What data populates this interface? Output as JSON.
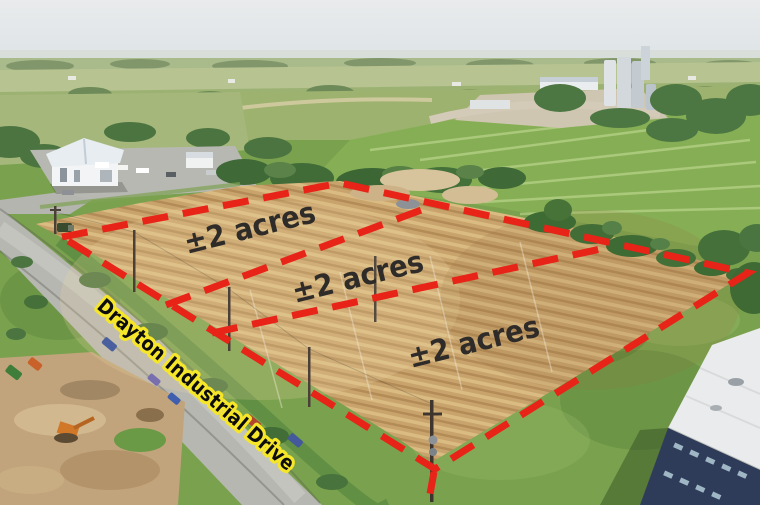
{
  "image": {
    "type": "aerial-drone-photo",
    "subject": "Graded dirt lot outlined with red dashed property boundary, divided into three parcels, beside Drayton Industrial Drive"
  },
  "overlay": {
    "boundary_color": "#e82318",
    "parcel_label_color": "#2e2b28",
    "parcels": [
      {
        "label": "±2 acres"
      },
      {
        "label": "±2 acres"
      },
      {
        "label": "±2 acres"
      }
    ],
    "road_label": {
      "text": "Drayton Industrial Drive",
      "text_color": "#0c0c0c",
      "outline_color": "#f6e62a"
    }
  },
  "photo": {
    "sky_color": "#e4e8ea",
    "distant_field_color": "#a9ba8b",
    "field_green": "#86af55",
    "grass_green": "#7aa24e",
    "tree_green": "#3f6937",
    "dirt_color": "#c9a36c",
    "road_color": "#b6b7b1",
    "warehouse_roof": "#e7edf1",
    "industrial_building_wall": "#2e3c5a",
    "industrial_building_roof": "#e9ebec"
  }
}
